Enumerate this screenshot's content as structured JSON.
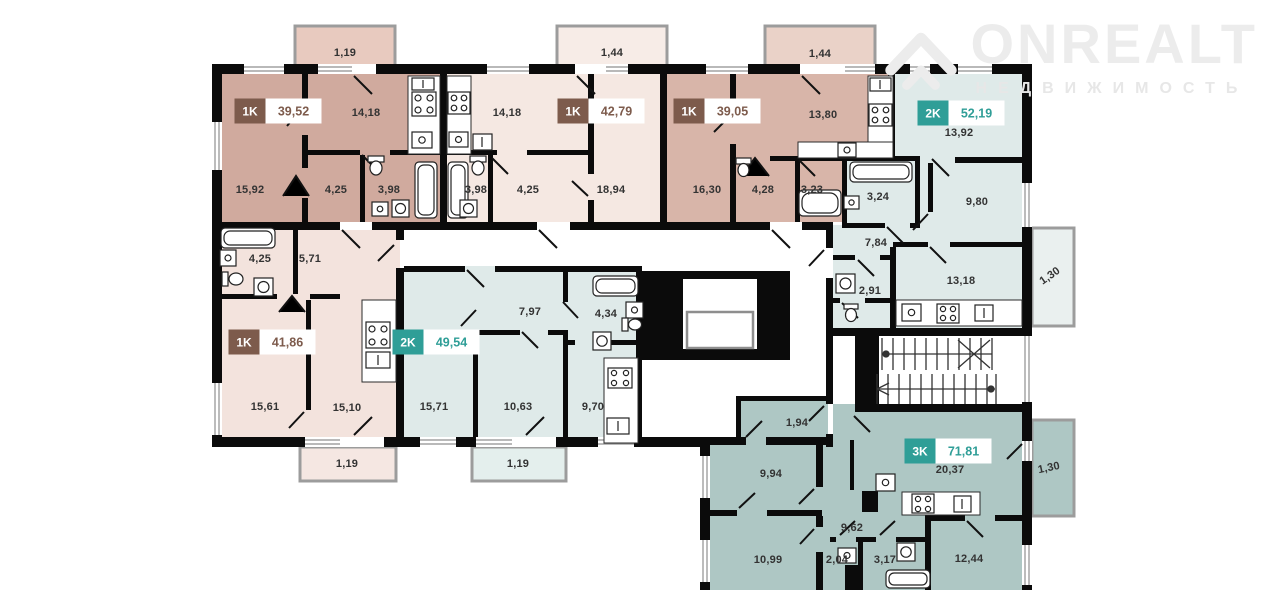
{
  "brand": {
    "name": "ONREALT",
    "tagline": "НЕДВИЖИМОСТЬ"
  },
  "units": {
    "a": {
      "type": "1K",
      "area": "39,52"
    },
    "b": {
      "type": "1K",
      "area": "42,79"
    },
    "c": {
      "type": "1K",
      "area": "39,05"
    },
    "d": {
      "type": "2K",
      "area": "52,19"
    },
    "e": {
      "type": "1K",
      "area": "41,86"
    },
    "f": {
      "type": "2K",
      "area": "49,54"
    },
    "g": {
      "type": "3K",
      "area": "71,81"
    }
  },
  "rooms": {
    "a_kitchen": "14,18",
    "a_living": "15,92",
    "a_hall": "4,25",
    "a_bath": "3,98",
    "b_kitchen": "14,18",
    "b_bath": "3,98",
    "b_hall": "4,25",
    "b_living": "18,94",
    "c_living": "16,30",
    "c_hall": "4,28",
    "c_bath": "3,23",
    "c_kitchen": "13,80",
    "d_room1": "13,92",
    "d_bath": "3,24",
    "d_room2": "9,80",
    "d_hall": "7,84",
    "d_wc": "2,91",
    "d_kitchen": "13,18",
    "e_bath": "4,25",
    "e_hall": "5,71",
    "e_living": "15,61",
    "e_kitchen": "15,10",
    "f_hall": "7,97",
    "f_bath": "4,34",
    "f_room1": "15,71",
    "f_room2": "10,63",
    "f_kitchen": "9,70",
    "g_room_small": "1,94",
    "g_room1": "9,94",
    "g_kitchen_living": "20,37",
    "g_hall": "9,62",
    "g_room2": "10,99",
    "g_wc": "2,04",
    "g_bath": "3,17",
    "g_room3": "12,44"
  },
  "balconies": {
    "top_left": "1,19",
    "top_mid": "1,44",
    "top_right": "1,44",
    "right_upper": "1,30",
    "right_lower": "1,30",
    "bottom_left": "1,19",
    "bottom_mid": "1,19"
  },
  "colors": {
    "badge_1k": "#7d5b4c",
    "badge_2k": "#2f9e97",
    "badge_3k": "#2f9e97",
    "fill_rose_dark": "#d0aa9e",
    "fill_rose_medium": "#d8b5a9",
    "fill_pink_light": "#f5e8e2",
    "fill_blue_light": "#dfeae9",
    "fill_teal": "#aec7c4",
    "wall": "#0b0b0b",
    "logo_gray": "#ececec"
  }
}
